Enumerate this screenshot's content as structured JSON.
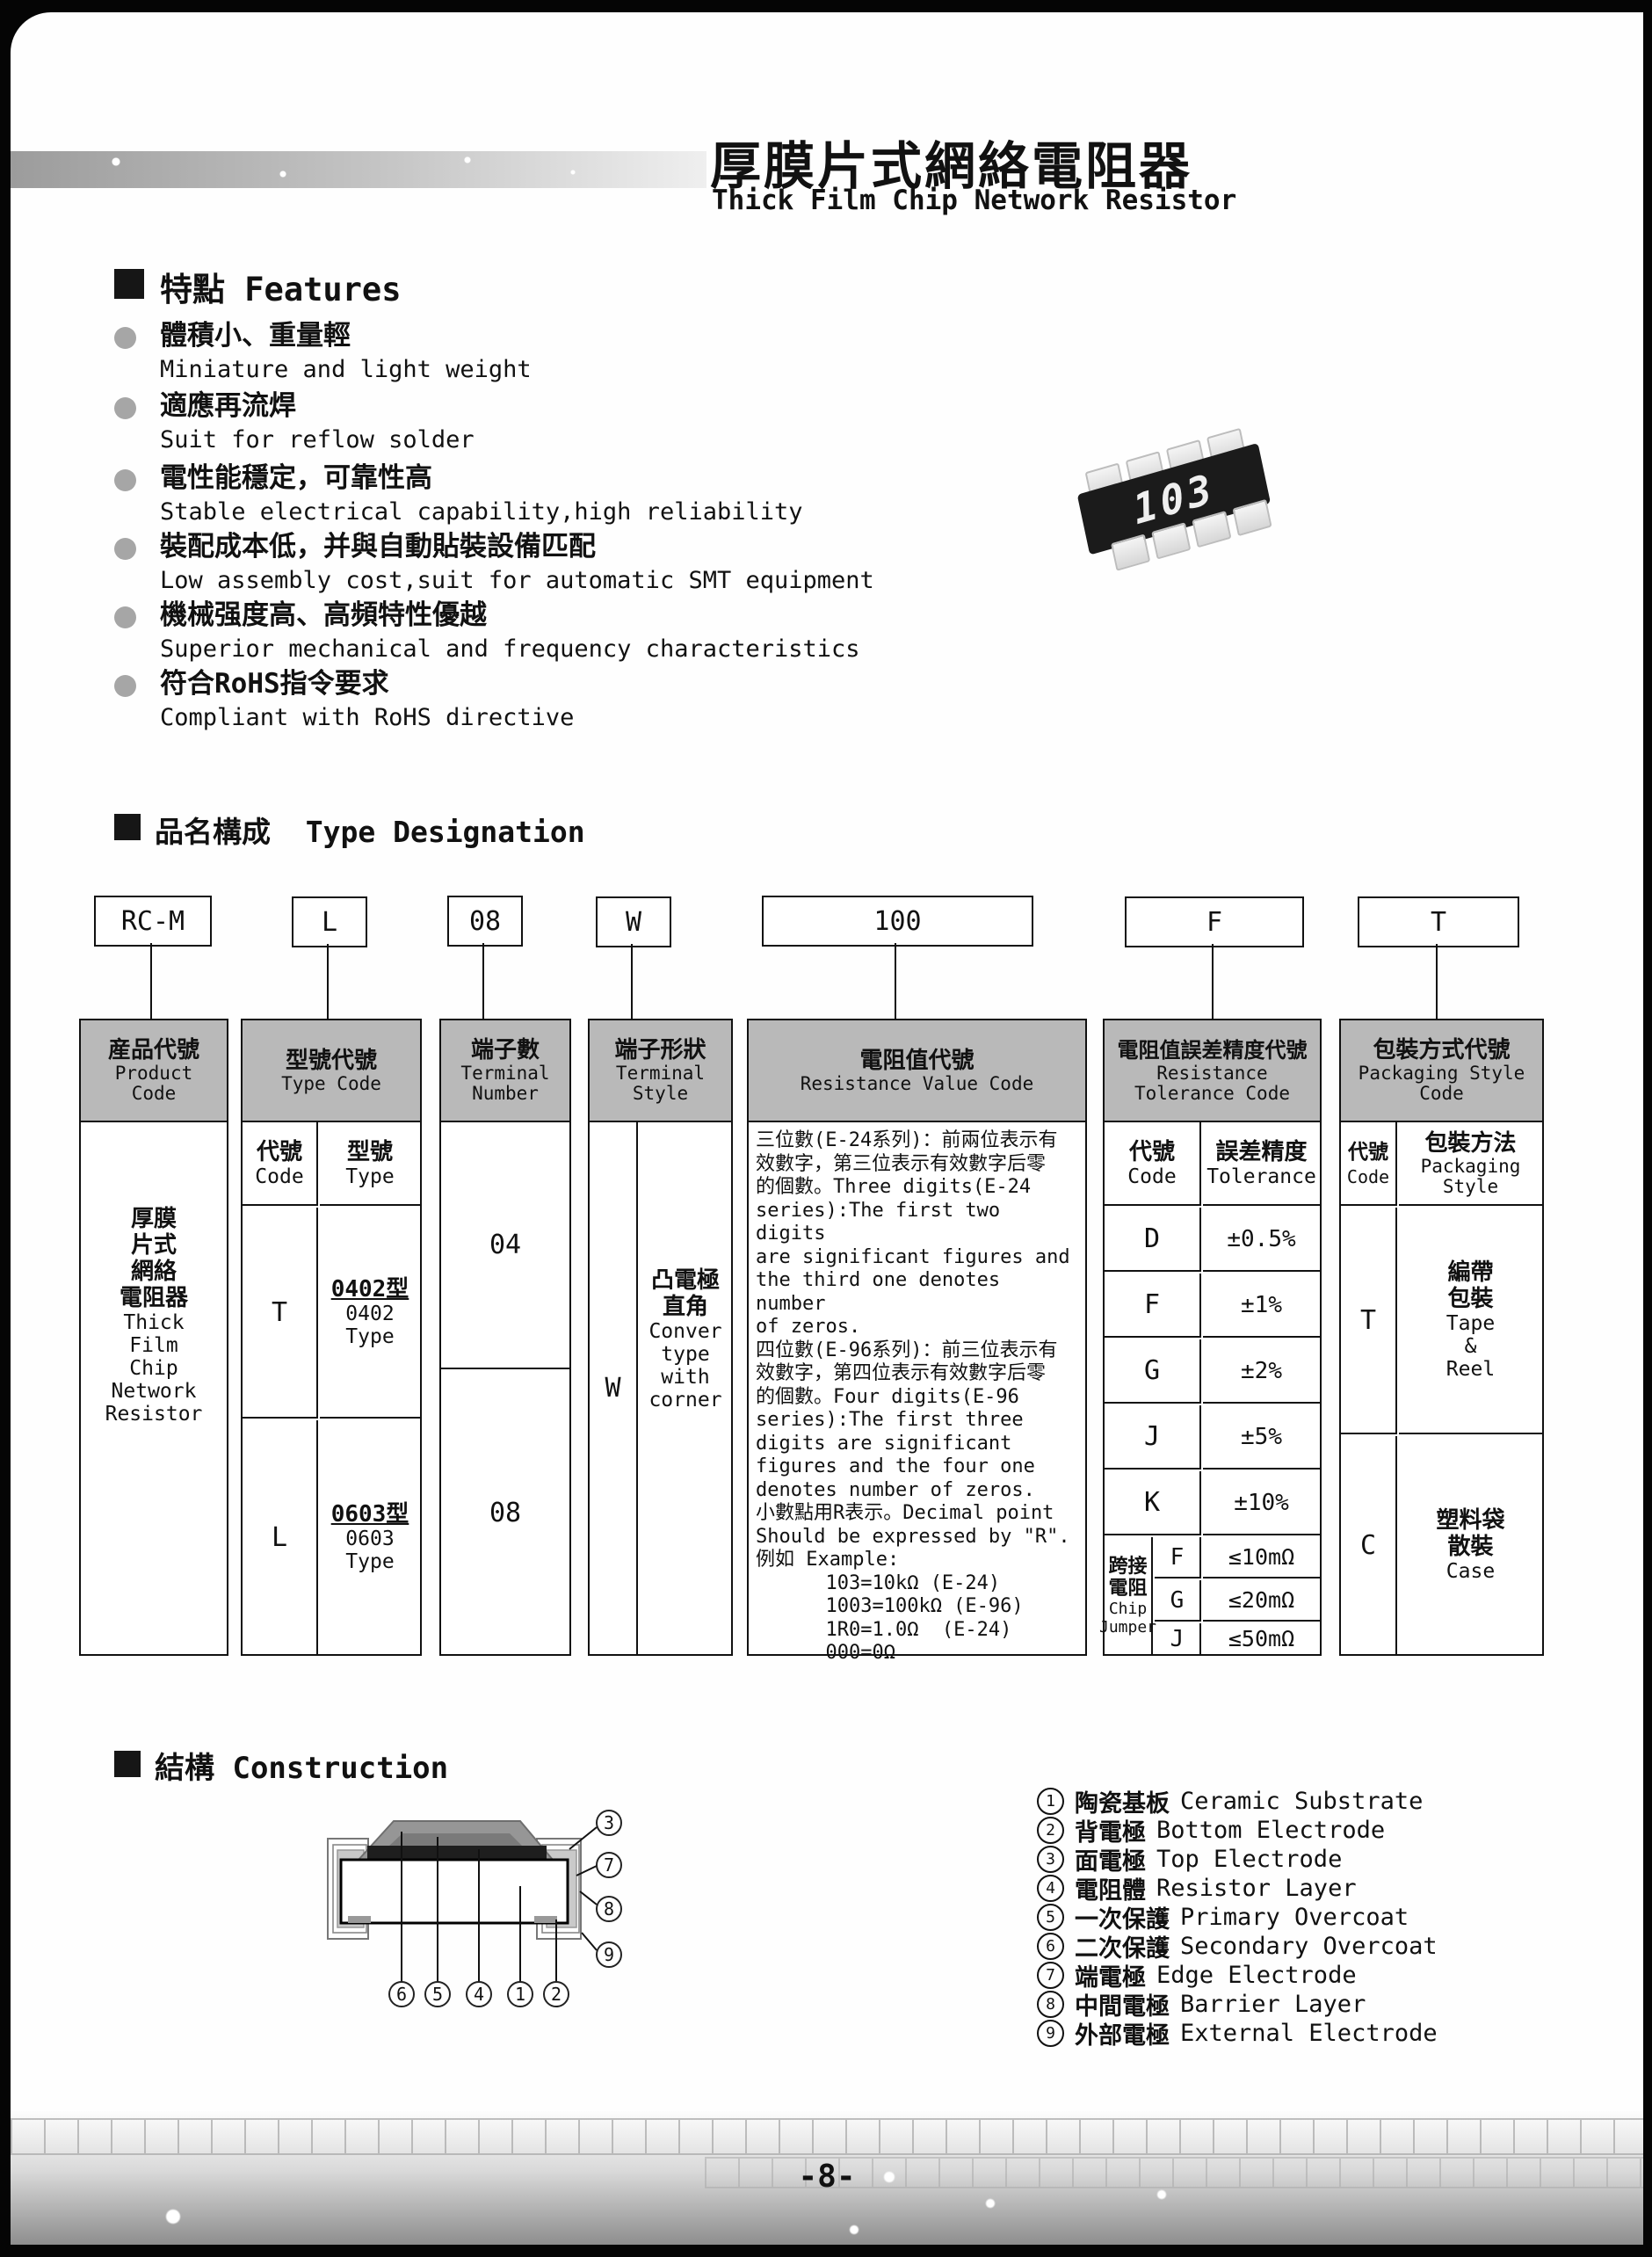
{
  "page": {
    "number": "-8-"
  },
  "header": {
    "title_zh": "厚膜片式網絡電阻器",
    "title_en": "Thick Film Chip Network Resistor"
  },
  "features": {
    "heading_zh": "特點",
    "heading_en": "Features",
    "items": [
      {
        "zh": "體積小、重量輕",
        "en": "Miniature and light weight"
      },
      {
        "zh": "適應再流焊",
        "en": "Suit for reflow solder"
      },
      {
        "zh": "電性能穩定，可靠性高",
        "en": "Stable electrical capability,high reliability"
      },
      {
        "zh": "裝配成本低，并與自動貼裝設備匹配",
        "en": "Low assembly cost,suit for automatic SMT equipment"
      },
      {
        "zh": "機械强度高、高頻特性優越",
        "en": "Superior mechanical and frequency characteristics"
      },
      {
        "zh": "符合RoHS指令要求",
        "en": "Compliant with RoHS directive"
      }
    ]
  },
  "chip": {
    "marking": "103"
  },
  "designation": {
    "heading_zh": "品名構成",
    "heading_en": "Type Designation",
    "codes": [
      "RC-M",
      "L",
      "08",
      "W",
      "100",
      "F",
      "T"
    ],
    "product": {
      "h_zh": "産品代號",
      "h_en": "Product\nCode",
      "body_zh": "厚膜\n片式\n網絡\n電阻器",
      "body_en": "Thick\nFilm\nChip\nNetwork\nResistor"
    },
    "type": {
      "h_zh": "型號代號",
      "h_en": "Type Code",
      "code_zh": "代號",
      "code_en": "Code",
      "type_zh": "型號",
      "type_en": "Type",
      "rows": [
        {
          "code": "T",
          "zh": "0402型",
          "en": "0402 Type"
        },
        {
          "code": "L",
          "zh": "0603型",
          "en": "0603 Type"
        }
      ]
    },
    "terminal_number": {
      "h_zh": "端子數",
      "h_en": "Terminal\nNumber",
      "values": [
        "04",
        "08"
      ]
    },
    "terminal_style": {
      "h_zh": "端子形狀",
      "h_en": "Terminal\nStyle",
      "code": "W",
      "zh": "凸電極\n直角",
      "en": "Conver\ntype\nwith\ncorner"
    },
    "resistance": {
      "h_zh": "電阻值代號",
      "h_en": "Resistance Value Code",
      "body": "三位數(E-24系列)：前兩位表示有\n效數字，第三位表示有效數字后零\n的個數。Three digits(E-24\nseries):The first two digits\nare significant figures and\nthe third one denotes number\nof zeros.\n四位數(E-96系列)：前三位表示有\n效數字，第四位表示有效數字后零\n的個數。Four digits(E-96\nseries):The first three\ndigits are significant\nfigures and the four one\ndenotes number of zeros.\n小數點用R表示。Decimal point\nShould be expressed by \"R\".\n例如 Example:\n      103=10kΩ (E-24)\n      1003=100kΩ (E-96)\n      1R0=1.0Ω  (E-24)\n      000=0Ω"
    },
    "tolerance": {
      "h_zh": "電阻值誤差精度代號",
      "h_en": "Resistance\nTolerance Code",
      "code_zh": "代號",
      "code_en": "Code",
      "tol_zh": "誤差精度",
      "tol_en": "Tolerance",
      "rows": [
        [
          "D",
          "±0.5%"
        ],
        [
          "F",
          "±1%"
        ],
        [
          "G",
          "±2%"
        ],
        [
          "J",
          "±5%"
        ],
        [
          "K",
          "±10%"
        ]
      ],
      "jumper_zh": "跨接\n電阻",
      "jumper_en": "Chip\nJumper",
      "jumper_rows": [
        [
          "F",
          "≤10mΩ"
        ],
        [
          "G",
          "≤20mΩ"
        ],
        [
          "J",
          "≤50mΩ"
        ]
      ]
    },
    "packaging": {
      "h_zh": "包裝方式代號",
      "h_en": "Packaging Style\nCode",
      "code_zh": "代號",
      "code_en": "Code",
      "style_zh": "包裝方法",
      "style_en": "Packaging\nStyle",
      "rows": [
        {
          "code": "T",
          "zh": "編帶\n包裝",
          "en": "Tape\n&\nReel"
        },
        {
          "code": "C",
          "zh": "塑料袋\n散裝",
          "en": "Case"
        }
      ]
    }
  },
  "construction": {
    "heading_zh": "結構",
    "heading_en": "Construction",
    "legend": [
      {
        "num": "1",
        "zh": "陶瓷基板",
        "en": "Ceramic Substrate"
      },
      {
        "num": "2",
        "zh": "背電極",
        "en": "Bottom Electrode"
      },
      {
        "num": "3",
        "zh": "面電極",
        "en": "Top Electrode"
      },
      {
        "num": "4",
        "zh": "電阻體",
        "en": "Resistor Layer"
      },
      {
        "num": "5",
        "zh": "一次保護",
        "en": "Primary Overcoat"
      },
      {
        "num": "6",
        "zh": "二次保護",
        "en": "Secondary Overcoat"
      },
      {
        "num": "7",
        "zh": "端電極",
        "en": "Edge Electrode"
      },
      {
        "num": "8",
        "zh": "中間電極",
        "en": "Barrier Layer"
      },
      {
        "num": "9",
        "zh": "外部電極",
        "en": "External Electrode"
      }
    ],
    "callouts_bottom": [
      "6",
      "5",
      "4",
      "1",
      "2"
    ],
    "callouts_right": [
      "3",
      "7",
      "8",
      "9"
    ]
  },
  "colors": {
    "table_header_gray": "#b9b9b9",
    "band_gray": "#c6c6c6",
    "chip_body": "#1b1b1b"
  }
}
